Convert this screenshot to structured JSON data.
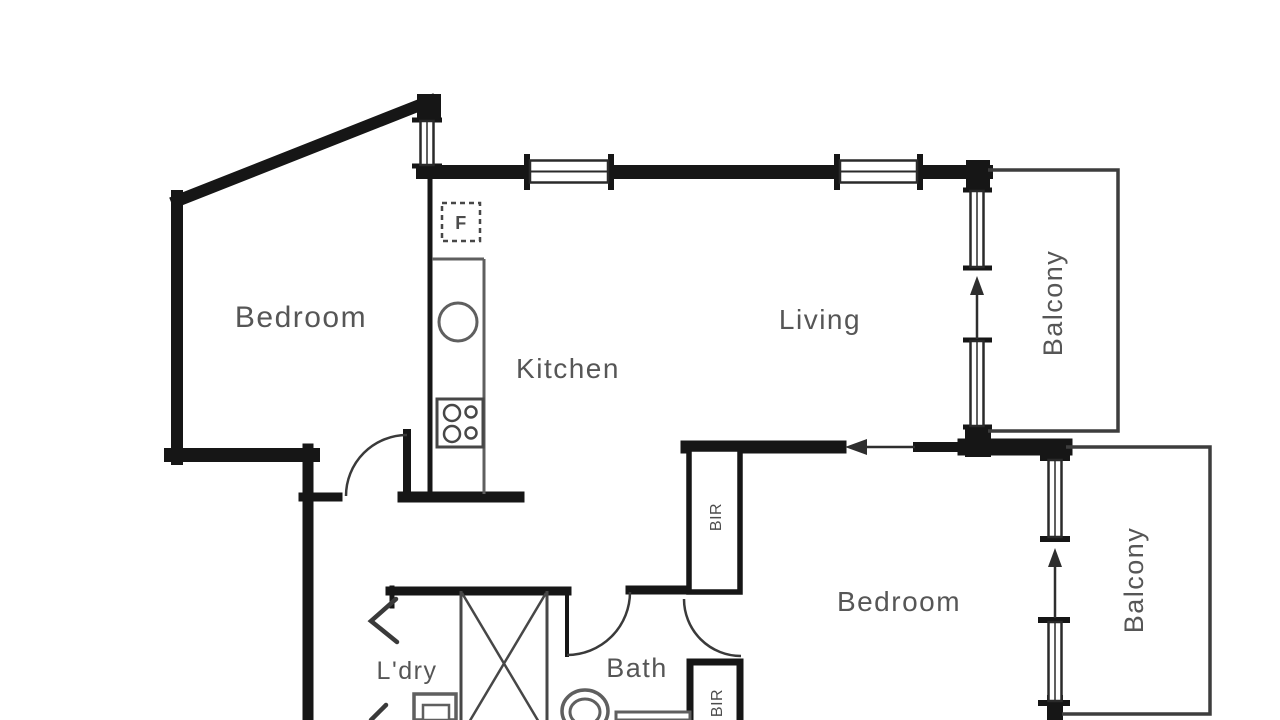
{
  "title": "Apartment floor plan",
  "colors": {
    "background": "#ffffff",
    "wall": "#161616",
    "thin_wall": "#3d3d3d",
    "fixture": "#5f5f5f",
    "label": "#565656"
  },
  "rooms": {
    "bedroom1": {
      "label": "Bedroom"
    },
    "kitchen": {
      "label": "Kitchen"
    },
    "living": {
      "label": "Living"
    },
    "balcony1": {
      "label": "Balcony"
    },
    "bedroom2": {
      "label": "Bedroom"
    },
    "balcony2": {
      "label": "Balcony"
    },
    "bath": {
      "label": "Bath"
    },
    "laundry": {
      "label": "L'dry"
    }
  },
  "fixtures": {
    "fridge": {
      "label": "F"
    },
    "robe1": {
      "label": "BIR"
    },
    "robe2": {
      "label": "BIR"
    }
  }
}
